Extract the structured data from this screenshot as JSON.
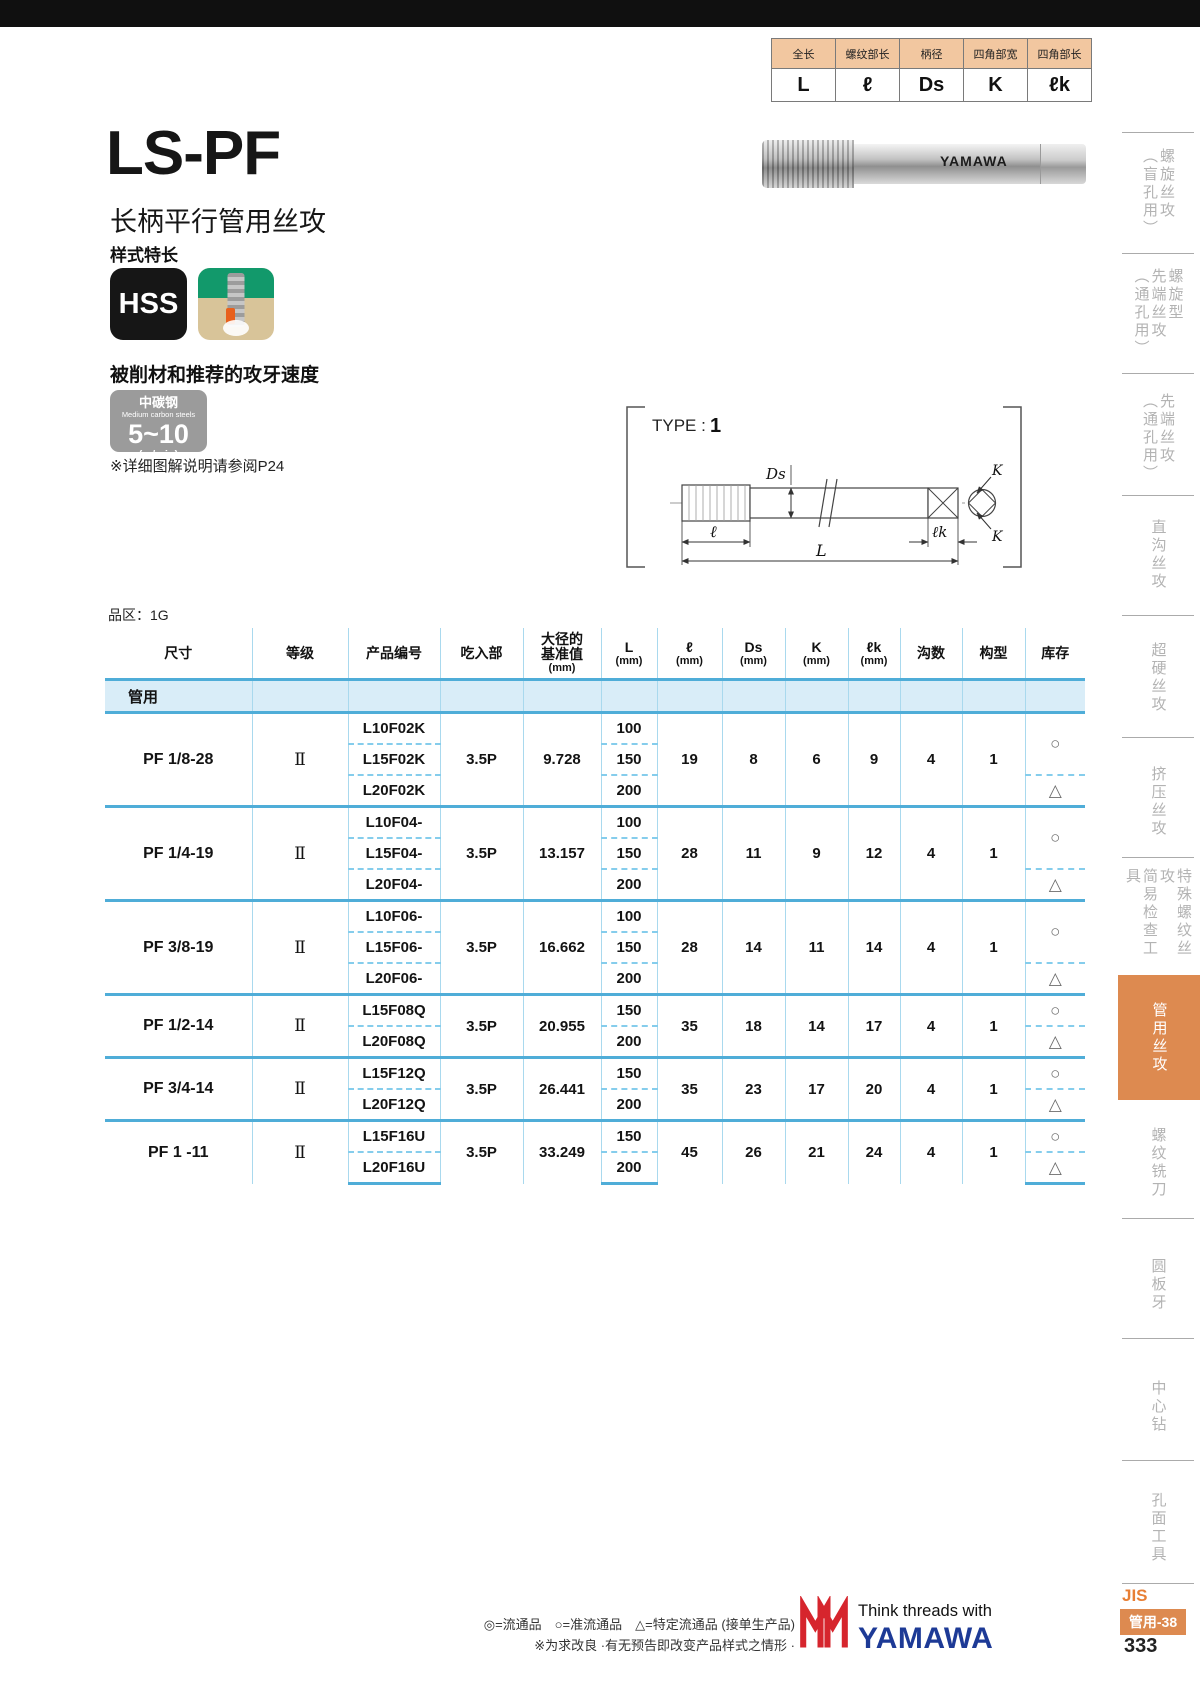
{
  "mini_table": {
    "headers": [
      "全长",
      "螺纹部长",
      "柄径",
      "四角部宽",
      "四角部长"
    ],
    "values": [
      "L",
      "ℓ",
      "Ds",
      "K",
      "ℓk"
    ]
  },
  "header": {
    "title": "LS-PF",
    "subtitle": "长柄平行管用丝攻",
    "style_note": "样式特长",
    "hss_badge": "HSS"
  },
  "photo": {
    "brand": "YAMAWA"
  },
  "speed": {
    "heading": "被削材和推荐的攻牙速度",
    "material_cn": "中碳钢",
    "material_en": "Medium carbon steels",
    "value": "5~10",
    "unit": "(m/min)",
    "note": "※详细图解说明请参阅P24"
  },
  "diagram": {
    "type_label": "TYPE :",
    "type_value": "1",
    "dims": {
      "ds": "Ds",
      "l": "ℓ",
      "L": "L",
      "lk": "ℓk",
      "K1": "K",
      "K2": "K"
    }
  },
  "table": {
    "area_label": "品区：1G",
    "headers": [
      {
        "l1": "尺寸"
      },
      {
        "l1": "等级"
      },
      {
        "l1": "产品编号"
      },
      {
        "l1": "吃入部"
      },
      {
        "l1": "大径的",
        "l2": "基准值",
        "l3": "(mm)"
      },
      {
        "l1": "L",
        "l3": "(mm)"
      },
      {
        "l1": "ℓ",
        "l3": "(mm)"
      },
      {
        "l1": "Ds",
        "l3": "(mm)"
      },
      {
        "l1": "K",
        "l3": "(mm)"
      },
      {
        "l1": "ℓk",
        "l3": "(mm)"
      },
      {
        "l1": "沟数"
      },
      {
        "l1": "构型"
      },
      {
        "l1": "库存"
      }
    ],
    "category": "管用",
    "groups": [
      {
        "size": "PF 1/8-28",
        "grade": "Ⅱ",
        "products": [
          "L10F02K",
          "L15F02K",
          "L20F02K"
        ],
        "chamfer": "3.5P",
        "basic_dia": "9.728",
        "L": [
          "100",
          "150",
          "200"
        ],
        "l": "19",
        "Ds": "8",
        "K": "6",
        "lk": "9",
        "flutes": "4",
        "type": "1",
        "stock": [
          "○",
          "△"
        ]
      },
      {
        "size": "PF 1/4-19",
        "grade": "Ⅱ",
        "products": [
          "L10F04-",
          "L15F04-",
          "L20F04-"
        ],
        "chamfer": "3.5P",
        "basic_dia": "13.157",
        "L": [
          "100",
          "150",
          "200"
        ],
        "l": "28",
        "Ds": "11",
        "K": "9",
        "lk": "12",
        "flutes": "4",
        "type": "1",
        "stock": [
          "○",
          "△"
        ]
      },
      {
        "size": "PF 3/8-19",
        "grade": "Ⅱ",
        "products": [
          "L10F06-",
          "L15F06-",
          "L20F06-"
        ],
        "chamfer": "3.5P",
        "basic_dia": "16.662",
        "L": [
          "100",
          "150",
          "200"
        ],
        "l": "28",
        "Ds": "14",
        "K": "11",
        "lk": "14",
        "flutes": "4",
        "type": "1",
        "stock": [
          "○",
          "△"
        ]
      },
      {
        "size": "PF 1/2-14",
        "grade": "Ⅱ",
        "products": [
          "L15F08Q",
          "L20F08Q"
        ],
        "chamfer": "3.5P",
        "basic_dia": "20.955",
        "L": [
          "150",
          "200"
        ],
        "l": "35",
        "Ds": "18",
        "K": "14",
        "lk": "17",
        "flutes": "4",
        "type": "1",
        "stock": [
          "○",
          "△"
        ]
      },
      {
        "size": "PF 3/4-14",
        "grade": "Ⅱ",
        "products": [
          "L15F12Q",
          "L20F12Q"
        ],
        "chamfer": "3.5P",
        "basic_dia": "26.441",
        "L": [
          "150",
          "200"
        ],
        "l": "35",
        "Ds": "23",
        "K": "17",
        "lk": "20",
        "flutes": "4",
        "type": "1",
        "stock": [
          "○",
          "△"
        ]
      },
      {
        "size": "PF 1 -11",
        "grade": "Ⅱ",
        "products": [
          "L15F16U",
          "L20F16U"
        ],
        "chamfer": "3.5P",
        "basic_dia": "33.249",
        "L": [
          "150",
          "200"
        ],
        "l": "45",
        "Ds": "26",
        "K": "21",
        "lk": "24",
        "flutes": "4",
        "type": "1",
        "stock": [
          "○",
          "△"
        ]
      }
    ]
  },
  "sidebar": {
    "items": [
      {
        "label": "螺旋丝攻\n（盲孔用）",
        "active": false
      },
      {
        "label": "螺旋型\n先端丝攻\n（通孔用）",
        "active": false
      },
      {
        "label": "先端丝攻\n（通孔用）",
        "active": false
      },
      {
        "label": "直沟丝攻",
        "active": false
      },
      {
        "label": "超硬丝攻",
        "active": false
      },
      {
        "label": "挤压丝攻",
        "active": false
      },
      {
        "label": "特殊螺纹丝攻\n简易检查工具",
        "active": false
      },
      {
        "label": "管用丝攻",
        "active": true
      },
      {
        "label": "螺纹铣刀",
        "active": false
      },
      {
        "label": "圆板牙",
        "active": false
      },
      {
        "label": "中心钻",
        "active": false
      },
      {
        "label": "孔面工具",
        "active": false
      }
    ]
  },
  "footer": {
    "legend": "◎=流通品　○=准流通品　△=特定流通品 (接单生产品)",
    "note": "※为求改良 ·有无预告即改变产品样式之情形 ·",
    "tagline": "Think threads with",
    "brand": "YAMAWA",
    "jis": "JIS",
    "page_tag": "管用-38",
    "page": "333"
  },
  "colors": {
    "accent_orange": "#dd8a50",
    "table_line_blue": "#4fadd8",
    "mini_header_peach": "#f2c7a0"
  }
}
